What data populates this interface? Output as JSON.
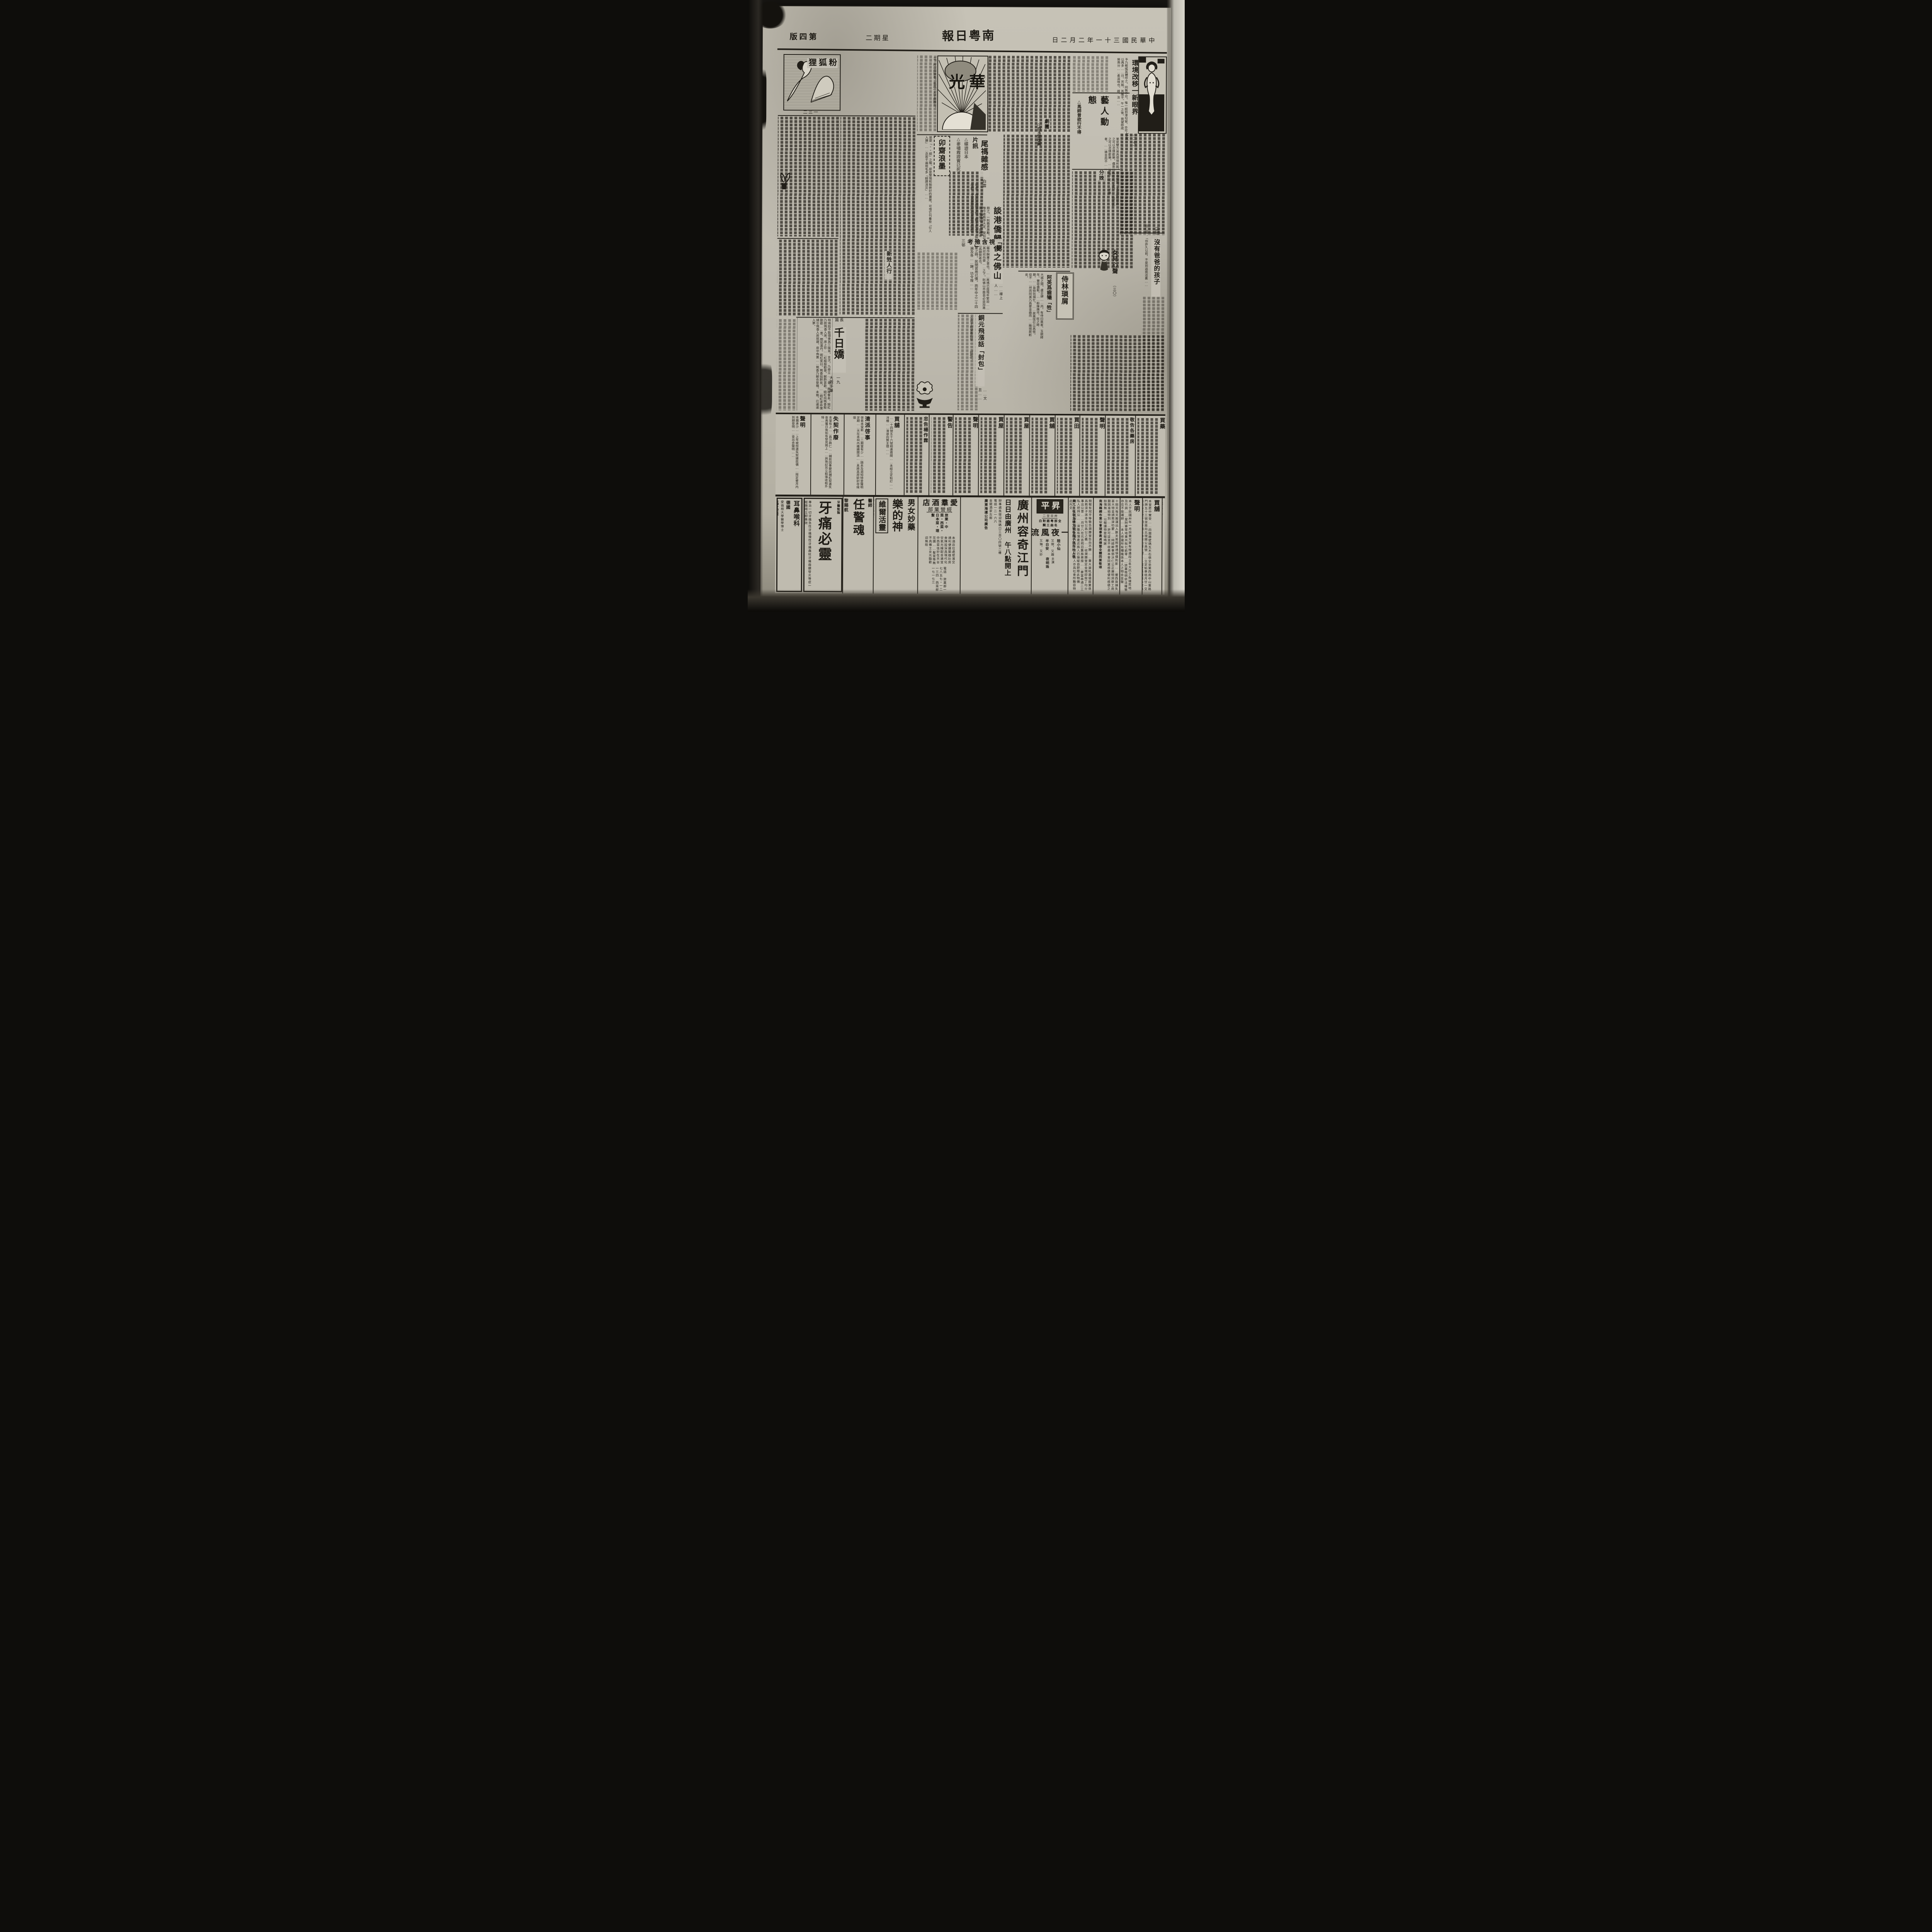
{
  "colors": {
    "paper": "#bdb9ae",
    "ink": "#211e18"
  },
  "paper": {
    "name": "南粤日報",
    "date": "中華民國三十一年二月二日",
    "weekday": "星期二",
    "page_label": "第四版"
  },
  "supplement": {
    "logo": "華光",
    "caption": "立。所以招致者。率爲一太平劇團云。"
  },
  "film_news": {
    "head": "片訊",
    "items": [
      "△蝶遊日本",
      "△麥嘯霞證實已死"
    ]
  },
  "entertainment": {
    "title": "藝人動態",
    "items": [
      "△馬師曾欲行不得",
      "劇團",
      "△白玉堂復興",
      "分娩"
    ],
    "excerpt": "第是雙方易爲環境所囿。形格勢禁。未易能如在此之可以恣情歡樂。儂意以爲在此。多作……如在此之可以恣情歡樂。……兩聲。花……不勝者。……猜合而不……"
  },
  "features": {
    "huanjing": {
      "num": "（二七）",
      "title": "環境改移一新眼界",
      "byline": "七友",
      "excerpt": "予乃輕搖其體呼之。囘無不可。惟一經到港勾留。亦可以再多……日。芳姊。其醒乎。午一之後。我望卽成勞燕分……柔滋味也。雌。汝……"
    },
    "maozhai": {
      "title": "卯齋浪墨",
      "excerpt": "甚麼「××經」之類。原是警惕和勉幹好的寶箴。可惜它刊着些「引人入勝」……念若干遍就毛多「銷譯消災」……"
    },
    "weima": {
      "title": "尾禡雜感",
      "byline": "白雲",
      "excerpt": "地矣。然而我國習俗。數千年來。皆爲行夏之時。民間習用已慣。而年中之二十四季節。尤爲農民所視爲農作時期……煌。遍及各……歸。功令煌……"
    },
    "tangang": {
      "title": "談港僑歸後之佛山",
      "byline": "……禪上人……",
      "excerpt": "飽之。一則藉資激勵。而一則藉作酬庸之意也。……尾禡已屆殘年緊迫……惟今者秩序大定。榮如前。又具欣欣向榮……之下。則佛山市面自必益加進展。僑諸公。今兹歸來……可爲額賀者也。"
    },
    "qinshi": {
      "title": "「親視含殮」考",
      "byline": "三邨"
    },
    "xinsheng": {
      "title": "新甡人行"
    },
    "shilin": {
      "title": "侍林瑣屑",
      "headline": "阿英爲齒犧「牲」",
      "excerpt": "大城之間。盧仝肆……丙。有侍曰英者。玉貌綺年。豐容盛鬋。……粉陳應市。旺之時期。……皆特別煩忙。……故英恆引以爲恨。從不……然而阿英乃爲愛金齒而……賤視厥躬矣。"
    },
    "tongyuan": {
      "title": "銅元飛漲話「封包」",
      "byline": "……文丑……",
      "excerpt": "小孩子盼望着的發……「封包」。"
    },
    "qianri": {
      "label": "長篇",
      "title": "千日嬌",
      "num": "一九",
      "byline": "大觀手筆",
      "excerpt": "特鳩拙不能領會其三昧耳。言次。乃旁立……昏。開晚餐矣。婉紅乃款珮香入席。席上珍……紅殷殷勸晉。觥酢甚歡。婉紅向珮香殷勤勸……意。顏如渥丹。婉紅笑曰。珮香姑醉矣。……婉紅遂命僕婦引珮香入房就寢。房中佈置……珮香乃解衣登榻。未幾。已遽遽入夢。"
    },
    "meiyou": {
      "num": "（四）",
      "title": "沒有爸爸的孩子",
      "excerpt": "伯仁道：「你許久以前，不是到過我這裏……"
    },
    "nver": {
      "title": "女兒心聲",
      "num": "（三〇）"
    },
    "fenhuli": {
      "title": "粉狐狸",
      "num": "一三二"
    }
  },
  "classifieds": {
    "items": [
      {
        "heading": "聲明",
        "excerpt": "本團承沙……上年被拐遺失契據茲價……限定壹月內到期登明……查出合聲明……"
      },
      {
        "heading": "失契作廢",
        "excerpt": "本堂有上……昌沙興仁……鋪前因事變該鋪紅契遺失查弗獲日後如有發見揭上……與珠記另立租簿收租外特……"
      },
      {
        "heading": "清派啓事",
        "excerpt": "啓者本堂新……二期當有少……踏未及週知特登聲明定期……天在本祠內繼續開派……息將其原欵封存候領"
      },
      {
        "heading": "買舖",
        "excerpt": "……十四號五十六號相連兩間……未經立定帖訂……洋樓……清速向賢主理……"
      },
      {
        "heading": "忠告楊作霖",
        "excerpt": ""
      },
      {
        "heading": "警告",
        "excerpt": ""
      },
      {
        "heading": "聲明",
        "excerpt": ""
      },
      {
        "heading": "買屋",
        "excerpt": ""
      },
      {
        "heading": "買屋",
        "excerpt": ""
      },
      {
        "heading": "買舖",
        "excerpt": ""
      },
      {
        "heading": "買田",
        "excerpt": ""
      },
      {
        "heading": "聲明",
        "excerpt": ""
      },
      {
        "heading": "敬告各藥房",
        "excerpt": ""
      },
      {
        "heading": "買藥",
        "excerpt": ""
      }
    ]
  },
  "ads": {
    "ent": {
      "region": "德國",
      "degree": "愛倫根大學醫學博士",
      "doctor": "馮兆華",
      "title": "耳鼻喉科",
      "suffix": "專門",
      "line1": "前任本市博愛醫院耳鼻咽喉科專門醫師",
      "addr": "西關十三甫路廿七號（近珠璣路）",
      "tel": "電話：一六九一三號"
    },
    "yatong": {
      "maker": "牙醫監製",
      "title": "牙痛必靈",
      "body": "專治一切牙痛急性牙痛慢性牙痛蟲蛀牙痛齒齦發炎等症一經施用立即奏效",
      "addr": "廣州大新東路一五六號",
      "dist": "民藥房總發行",
      "tel": "電話一一八四八",
      "note": "各藥房均有售"
    },
    "renjing": {
      "prefix": "醫師",
      "title": "任警魂",
      "doctor": "黎賜航",
      "line1": "主理婦女醫暗病白帶閉經",
      "line2": "麻瘋收費一元立決憂疑",
      "addr1": "會所廣州一德西路四四四號",
      "addr2": "分所太平南路八八號",
      "side": "花柳白濁皮膚專科針灸專家"
    },
    "ledeshen": {
      "cat": "男女妙藥",
      "title": "樂的神",
      "product": "維爾活靈",
      "line1": "補血健腦強腎",
      "line2": "返老還童滋陰振性能",
      "line3": "青年虧損老弱無能有婦之夫有夫之婦服之立有意想不到之效",
      "line4": "生殖外用壯腎增愛其妙無窮",
      "dist": "經理廣州一德路四〇六神州藥行",
      "note": "到處藥房藥局均有售"
    },
    "aiqun": {
      "title": "愛羣酒店",
      "dept": "經營業部",
      "services": "旅業・中菜・西菜・日本菜・理髮",
      "body": "本酒店位處堤濱交通利便建築雄壯房舍陳設深具現代化空氣光線配合適宜中西菜佳妙在天台花園……髮室等無不具備士女光臨歡迎無既",
      "tel": "電話 旅業部一七八五七・一二一三四 西菜部一七一七三"
    },
    "ferry": {
      "route": "廣州容奇江門",
      "schedule": "日日由廣州 午八點開上",
      "office": "辦事處長堤迎珠碼口三百〇四號二樓",
      "tel": "電話一二一六六",
      "landmark": "金龍酒家左鄰",
      "company": "廣東海運公司廣告"
    },
    "shengping": {
      "name": "昇平",
      "dates": "卅日至二",
      "lang": "全部粤語對白",
      "songs": "名曲三闋",
      "film": "一夜風流",
      "star": "夜明珠",
      "role": "主演",
      "cast1": "半日安",
      "cast2": "陸小仙",
      "blurb1": "又抽，又妙",
      "blurb2": "又做，又趣"
    }
  },
  "notices": {
    "clan": {
      "excerpt": "閱報有冠平等敬告潤勝堂告白不勝……賣大渠吼基塘屋業係爲救濟子孫本化公爲公之義……收潤勝堂定金現卽按丁均分事出公意……月廿八在元吉祠召集族衆接……豪富串通二三私人把持公……濟雖有薄產近族人已操縱自肥際此物價飛……人飢寒於漠視此種行爲不容於族人亦爲社會所難容特此斥爻",
      "sig": "黃兀吉祖宗主煒文堂各房子孫百卅人啓"
    },
    "thanks": {
      "excerpt": "十餘天每天搬運出入數夫若照普通領價則影……響西貨損失甚大特呈請救濟叻蒙……純總幹事鄧沃仁公正廉明洞察工商艱困准給特別……許可証並不收費本會同業感德便利感德之餘愧無……以報謹特登報鳴謝",
      "sig": "南海縣綢布業公會理事黃貞煒暨全體同業敬頌"
    },
    "statement": {
      "heading": "聲明",
      "excerpt": "本人于民國卅年一月與黃兄買有樟邊段土名大巴之魚塘荒地及竹與……里附寨常地黃共稅七畝零……該業租明依法權管存在不能確耕……本人修建所有種植係本人之物合並聲明……黃浚榮啓"
    },
    "maipu": {
      "heading": "買舖",
      "excerpt": "本堂愿中實受……四圍牆壁碼瓦木石俱全坐第西南中山東路門牌五十三號坐南向北現開公昌號……立定帖準桔月廿一交易倘有來歷不明彥暢未清速向賣主理……經交易慨與本堂無涉特登報聲明",
      "sig": "德安堂啓"
    },
    "gongsong": {
      "heading": "恭頌",
      "body": "南海縣物資配給委員會兼主任委員李公道純暨總幹事龐沃仁惠及同人……業晒莨紗綢工場設在佛山市郊每次西莨完成頃特鳴謝"
    }
  }
}
